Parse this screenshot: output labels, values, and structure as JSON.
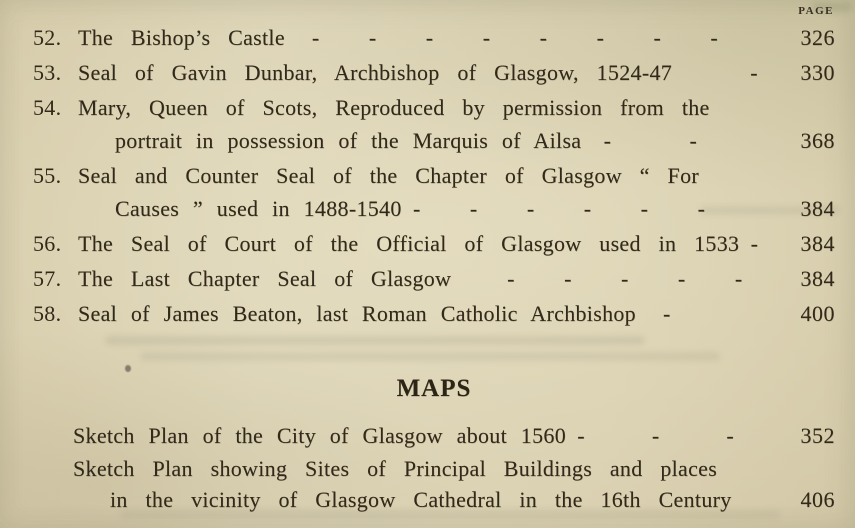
{
  "page_header": {
    "label": "PAGE"
  },
  "illustrations": {
    "items": [
      {
        "number": "52.",
        "lines": [
          "The Bishop’s Castle  -   -   -   -   -   -   -   -"
        ],
        "page": "326"
      },
      {
        "number": "53.",
        "lines": [
          "Seal of Gavin Dunbar, Archbishop of Glasgow, 1524-47    -"
        ],
        "page": "330"
      },
      {
        "number": "54.",
        "lines": [
          "Mary, Queen of Scots, Reproduced by permission from the",
          "portrait in possession of the Marquis of Ailsa -    -"
        ],
        "page": "368"
      },
      {
        "number": "55.",
        "lines": [
          "Seal and Counter Seal of the Chapter of Glasgow “ For",
          "Causes ” used in 1488-1540 -   -   -   -   -   -"
        ],
        "page": "384"
      },
      {
        "number": "56.",
        "lines": [
          "The Seal of Court of the Official of Glasgow used in 1533 -"
        ],
        "page": "384"
      },
      {
        "number": "57.",
        "lines": [
          "The Last Chapter Seal of Glasgow   -   -   -   -   -"
        ],
        "page": "384"
      },
      {
        "number": "58.",
        "lines": [
          "Seal of James Beaton, last Roman Catholic Archbishop  -"
        ],
        "page": "400"
      }
    ]
  },
  "maps": {
    "heading": "MAPS",
    "items": [
      {
        "lines": [
          "Sketch Plan of the City of Glasgow about 1560 -   -   -"
        ],
        "page": "352"
      },
      {
        "lines": [
          "Sketch Plan showing Sites of Principal Buildings and places",
          "in the vicinity of Glasgow Cathedral in the 16th Century"
        ],
        "page": "406"
      }
    ]
  }
}
